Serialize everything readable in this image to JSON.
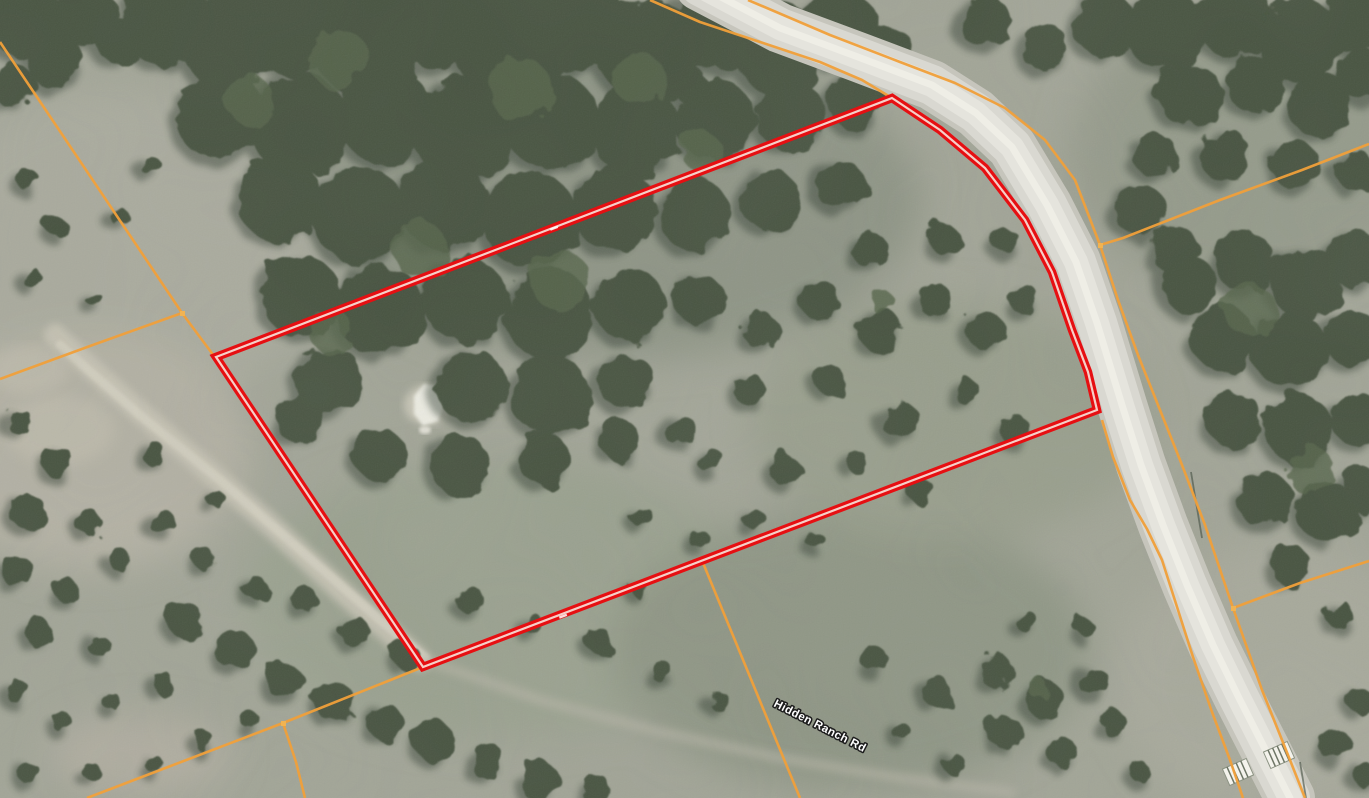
{
  "map": {
    "road_label": "Hidden Ranch Rd",
    "colors": {
      "parcel_red": "#e60f12",
      "parcel_core": "#f6cfc8",
      "boundary_orange": "#f1a03a",
      "road_surface": "#d9d8d1",
      "terrain": "#a1a496",
      "tree_canopy": "#46523f",
      "label_text": "#ffffff",
      "label_halo": "#1c1c1c"
    }
  }
}
